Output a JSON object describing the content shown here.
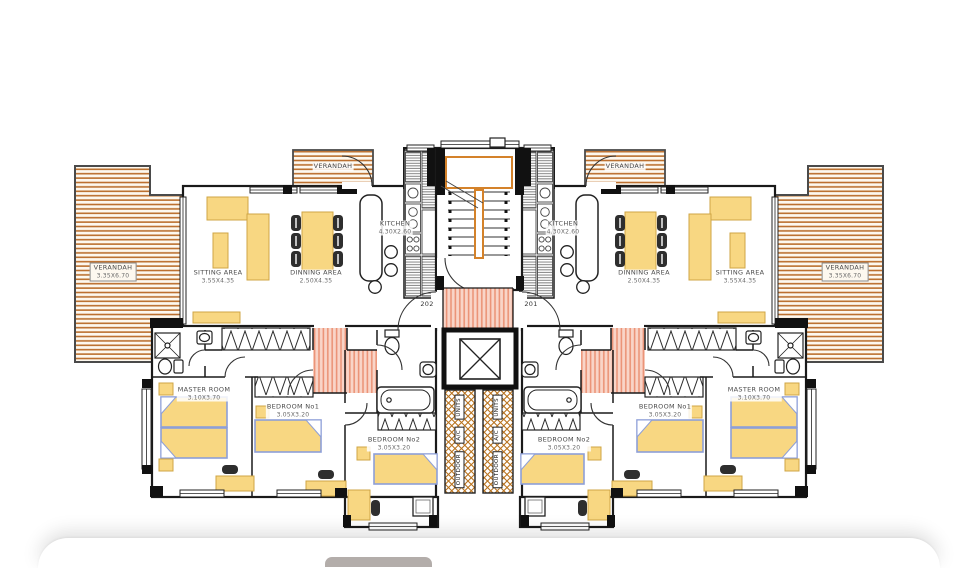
{
  "drawing": {
    "title_hint": "apartment floor plan, two mirrored units",
    "units": {
      "left": {
        "unit_number": "202",
        "verandah_main": {
          "name": "VERANDAH",
          "dims": "3.35X6.70"
        },
        "verandah_top": {
          "name": "VERANDAH"
        },
        "sitting": {
          "name": "SITTING AREA",
          "dims": "3.55X4.35"
        },
        "dinning": {
          "name": "DINNING AREA",
          "dims": "2.50X4.35"
        },
        "kitchen": {
          "name": "KITCHEN",
          "dims": "4.30X2.60"
        },
        "master": {
          "name": "MASTER ROOM",
          "dims": "3.10X3.70"
        },
        "bedroom1": {
          "name": "BEDROOM No1",
          "dims": "3.05X3.20"
        },
        "bedroom2": {
          "name": "BEDROOM No2",
          "dims": "3.05X3.20"
        }
      },
      "right": {
        "unit_number": "201",
        "verandah_main": {
          "name": "VERANDAH",
          "dims": "3.35X6.70"
        },
        "verandah_top": {
          "name": "VERANDAH"
        },
        "sitting": {
          "name": "SITTING AREA",
          "dims": "3.55X4.35"
        },
        "dinning": {
          "name": "DINNING AREA",
          "dims": "2.50X4.35"
        },
        "kitchen": {
          "name": "KITCHEN",
          "dims": "4.30X2.60"
        },
        "master": {
          "name": "MASTER ROOM",
          "dims": "3.10X3.70"
        },
        "bedroom1": {
          "name": "BEDROOM No1",
          "dims": "3.05X3.20"
        },
        "bedroom2": {
          "name": "BEDROOM No2",
          "dims": "3.05X3.20"
        }
      }
    },
    "ac_strip_words": {
      "top": "UNITS",
      "middle": "A/C",
      "bottom": "OUTDOOR"
    },
    "colors": {
      "deck_line": "#bb6f2e",
      "furniture_fill": "#f8d782",
      "bed_outline": "#8d9fd8",
      "hall_hatch": "#eb9478",
      "ac_hatch": "#b9731e",
      "stair_accent": "#d4822a",
      "wall": "#1a1a1a",
      "sheet_button": "#b3adaa"
    }
  }
}
